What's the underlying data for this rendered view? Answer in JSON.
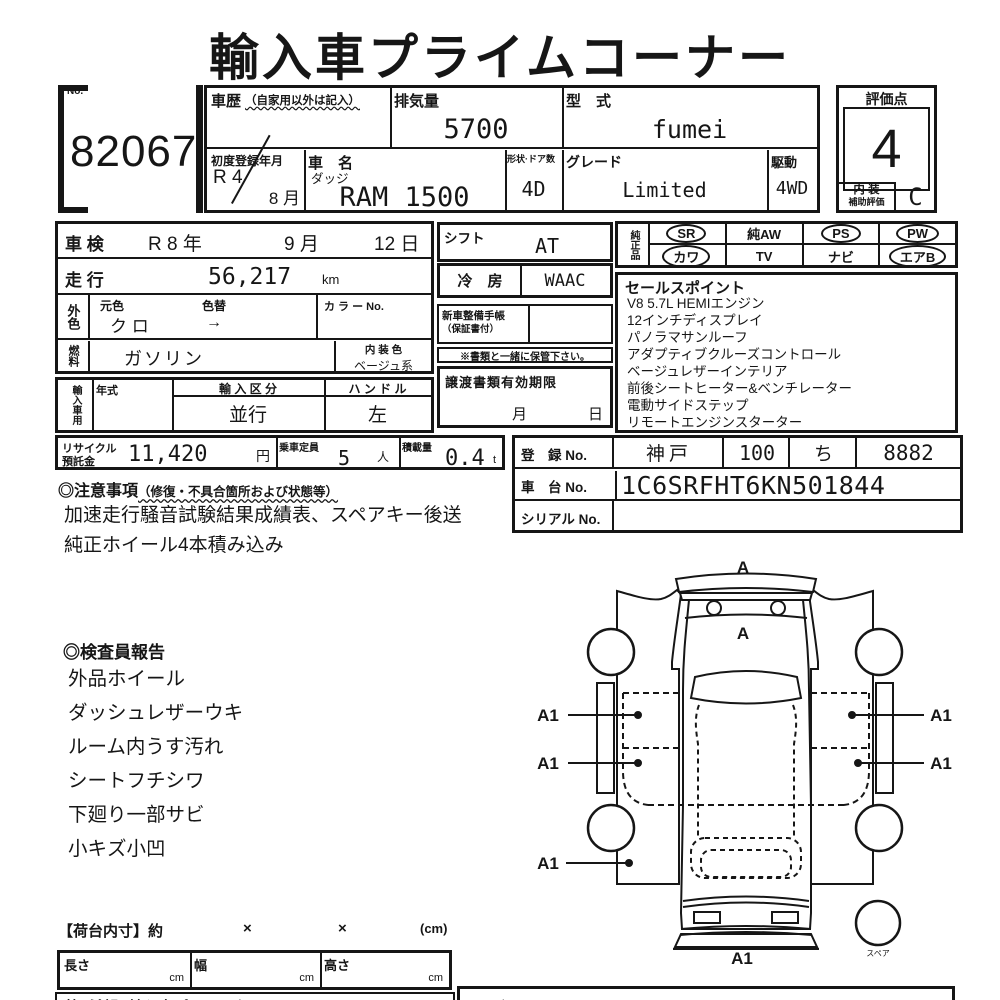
{
  "title": "輸入車プライムコーナー",
  "lot": {
    "no_label": "No.",
    "number": "82067"
  },
  "header": {
    "history_label": "車歴",
    "history_note": "（自家用以外は記入）",
    "displacement_label": "排気量",
    "displacement": "5700",
    "model_code_label": "型　式",
    "model_code": "fumei",
    "first_reg_label": "初度登録年月",
    "first_reg_year": "R 4",
    "first_reg_month": "8 月",
    "car_name_label": "車　名",
    "maker": "ダッジ",
    "car_name": "RAM 1500",
    "doors_label": "形状·ドア数",
    "doors": "4D",
    "grade_label": "グレード",
    "grade": "Limited",
    "drive_label": "駆動",
    "drive": "4WD"
  },
  "rating": {
    "score_label": "評価点",
    "score": "4",
    "interior_line1": "内 装",
    "interior_line2": "補助評価",
    "interior_grade": "C"
  },
  "left": {
    "shaken_label": "車 検",
    "shaken_y": "R 8 年",
    "shaken_m": "9 月",
    "shaken_d": "12 日",
    "mileage_label": "走 行",
    "mileage": "56,217",
    "mileage_unit": "km",
    "ext_label": "外色",
    "base_color_label": "元色",
    "color_change_label": "色替",
    "base_color": "ク ロ",
    "color_change_arrow": "→",
    "color_no_label": "カ ラ ー No.",
    "fuel_label": "燃料",
    "fuel": "ガソリン",
    "int_color_label": "内 装 色",
    "int_color": "ベージュ系",
    "import_label": "輸入車用",
    "year_label": "年式",
    "import_class_label": "輸 入 区 分",
    "import_class": "並行",
    "handle_label": "ハ ン ド ル",
    "handle": "左"
  },
  "mid": {
    "shift_label": "シフト",
    "shift": "AT",
    "ac_label": "冷　房",
    "ac": "WAAC",
    "service1": "新車整備手帳",
    "service2": "（保証書付）",
    "keep_note": "※書類と一緒に保管下さい。",
    "transfer_label": "譲渡書類有効期限",
    "month": "月",
    "day": "日"
  },
  "genuine": {
    "label": "純正品",
    "items": [
      {
        "text": "SR",
        "circled": true
      },
      {
        "text": "純AW",
        "circled": false
      },
      {
        "text": "PS",
        "circled": true
      },
      {
        "text": "PW",
        "circled": true
      },
      {
        "text": "カワ",
        "circled": true
      },
      {
        "text": "TV",
        "circled": false
      },
      {
        "text": "ナビ",
        "circled": false
      },
      {
        "text": "エアB",
        "circled": true
      }
    ]
  },
  "sales": {
    "title": "セールスポイント",
    "items": [
      "V8 5.7L HEMIエンジン",
      "12インチディスプレイ",
      "パノラマサンルーフ",
      "アダプティブクルーズコントロール",
      "ベージュレザーインテリア",
      "前後シートヒーター&ベンチレーター",
      "電動サイドステップ",
      "リモートエンジンスターター"
    ]
  },
  "recycle": {
    "l1": "リサイクル",
    "l2": "預託金",
    "amount": "11,420",
    "yen": "円",
    "cap_label": "乗車定員",
    "cap": "5",
    "cap_unit": "人",
    "load_label": "積載量",
    "load": "0.4",
    "load_unit": "t"
  },
  "reg": {
    "reg_label": "登　録 No.",
    "area": "神戸",
    "cls": "100",
    "kana": "ち",
    "num": "8882",
    "chassis_label": "車　台 No.",
    "chassis": "1C6SRFHT6KN501844",
    "serial_label": "シリアル No.",
    "serial": ""
  },
  "notes": {
    "head": "◎注意事項",
    "head_note": "（修復・不具合箇所および状態等）",
    "line1": "加速走行騒音試験結果成績表、スペアキー後送",
    "line2": "純正ホイール4本積み込み"
  },
  "inspector": {
    "head": "◎検査員報告",
    "items": [
      "外品ホイール",
      "ダッシュレザーウキ",
      "ルーム内うす汚れ",
      "シートフチシワ",
      "下廻り一部サビ",
      "小キズ小凹"
    ]
  },
  "diagram": {
    "front": "A",
    "hood": "A",
    "left1": "A1",
    "left2": "A1",
    "left3": "A1",
    "right1": "A1",
    "right2": "A1",
    "rear": "A1",
    "spare_label": "スペア"
  },
  "bed": {
    "head": "【荷台内寸】約",
    "x1": "×",
    "x2": "×",
    "unit": "(cm)",
    "len": "長さ",
    "wid": "幅",
    "hei": "高さ",
    "cm": "cm"
  },
  "footer": {
    "wish": "第1希望:(輸入車プライムタイム)",
    "right_label": "入庫No."
  }
}
